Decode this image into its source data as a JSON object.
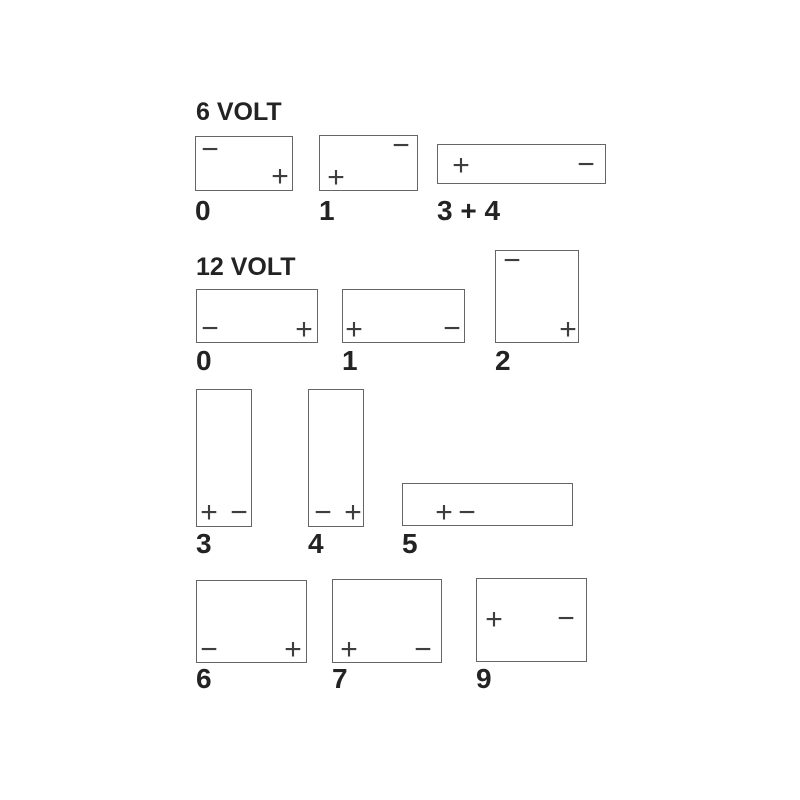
{
  "diagram": {
    "title": "Battery terminal layout diagram",
    "width": 800,
    "height": 800,
    "background": "#ffffff"
  },
  "colors": {
    "box_border": "#666666",
    "box_fill": "#ffffff",
    "heading_text": "#232323",
    "label_text": "#232323",
    "terminal_symbol": "#3e3e3e"
  },
  "sections": [
    {
      "title": "6 VOLT",
      "title_pos": {
        "x": 196,
        "y": 100
      },
      "batteries": [
        {
          "id": "6v-0",
          "label": "0",
          "label_y": 197,
          "box": {
            "x": 195,
            "y": 136,
            "w": 98,
            "h": 55
          },
          "terminals": [
            {
              "polarity": "negative",
              "glyph": "−",
              "x": 14,
              "y": 13
            },
            {
              "polarity": "positive",
              "glyph": "+",
              "x": 84,
              "y": 40
            }
          ]
        },
        {
          "id": "6v-1",
          "label": "1",
          "label_y": 197,
          "box": {
            "x": 319,
            "y": 135,
            "w": 99,
            "h": 56
          },
          "terminals": [
            {
              "polarity": "negative",
              "glyph": "−",
              "x": 81,
              "y": 10
            },
            {
              "polarity": "positive",
              "glyph": "+",
              "x": 16,
              "y": 42
            }
          ]
        },
        {
          "id": "6v-3-4",
          "label": "3 + 4",
          "label_y": 197,
          "box": {
            "x": 437,
            "y": 144,
            "w": 169,
            "h": 40
          },
          "terminals": [
            {
              "polarity": "positive",
              "glyph": "+",
              "x": 23,
              "y": 21
            },
            {
              "polarity": "negative",
              "glyph": "−",
              "x": 148,
              "y": 20
            }
          ]
        }
      ]
    },
    {
      "title": "12 VOLT",
      "title_pos": {
        "x": 196,
        "y": 255
      },
      "batteries": [
        {
          "id": "12v-0",
          "label": "0",
          "label_y": 347,
          "box": {
            "x": 196,
            "y": 289,
            "w": 122,
            "h": 54
          },
          "terminals": [
            {
              "polarity": "negative",
              "glyph": "−",
              "x": 13,
              "y": 39
            },
            {
              "polarity": "positive",
              "glyph": "+",
              "x": 107,
              "y": 40
            }
          ]
        },
        {
          "id": "12v-1",
          "label": "1",
          "label_y": 347,
          "box": {
            "x": 342,
            "y": 289,
            "w": 123,
            "h": 54
          },
          "terminals": [
            {
              "polarity": "positive",
              "glyph": "+",
              "x": 11,
              "y": 40
            },
            {
              "polarity": "negative",
              "glyph": "−",
              "x": 109,
              "y": 39
            }
          ]
        },
        {
          "id": "12v-2",
          "label": "2",
          "label_y": 347,
          "box": {
            "x": 495,
            "y": 250,
            "w": 84,
            "h": 93
          },
          "terminals": [
            {
              "polarity": "negative",
              "glyph": "−",
              "x": 16,
              "y": 10
            },
            {
              "polarity": "positive",
              "glyph": "+",
              "x": 72,
              "y": 79
            }
          ]
        }
      ]
    },
    {
      "batteries": [
        {
          "id": "12v-3",
          "label": "3",
          "label_y": 530,
          "box": {
            "x": 196,
            "y": 389,
            "w": 56,
            "h": 138
          },
          "terminals": [
            {
              "polarity": "positive",
              "glyph": "+",
              "x": 12,
              "y": 123
            },
            {
              "polarity": "negative",
              "glyph": "−",
              "x": 42,
              "y": 123
            }
          ]
        },
        {
          "id": "12v-4",
          "label": "4",
          "label_y": 530,
          "box": {
            "x": 308,
            "y": 389,
            "w": 56,
            "h": 138
          },
          "terminals": [
            {
              "polarity": "negative",
              "glyph": "−",
              "x": 14,
              "y": 123
            },
            {
              "polarity": "positive",
              "glyph": "+",
              "x": 44,
              "y": 123
            }
          ]
        },
        {
          "id": "12v-5",
          "label": "5",
          "label_y": 530,
          "box": {
            "x": 402,
            "y": 483,
            "w": 171,
            "h": 43
          },
          "terminals": [
            {
              "polarity": "positive",
              "glyph": "+",
              "x": 41,
              "y": 29
            },
            {
              "polarity": "negative",
              "glyph": "−",
              "x": 64,
              "y": 29
            }
          ]
        }
      ]
    },
    {
      "batteries": [
        {
          "id": "12v-6",
          "label": "6",
          "label_y": 665,
          "box": {
            "x": 196,
            "y": 580,
            "w": 111,
            "h": 83
          },
          "terminals": [
            {
              "polarity": "negative",
              "glyph": "−",
              "x": 12,
              "y": 69
            },
            {
              "polarity": "positive",
              "glyph": "+",
              "x": 96,
              "y": 69
            }
          ]
        },
        {
          "id": "12v-7",
          "label": "7",
          "label_y": 665,
          "box": {
            "x": 332,
            "y": 579,
            "w": 110,
            "h": 84
          },
          "terminals": [
            {
              "polarity": "positive",
              "glyph": "+",
              "x": 16,
              "y": 70
            },
            {
              "polarity": "negative",
              "glyph": "−",
              "x": 90,
              "y": 70
            }
          ]
        },
        {
          "id": "12v-9",
          "label": "9",
          "label_y": 665,
          "box": {
            "x": 476,
            "y": 578,
            "w": 111,
            "h": 84
          },
          "terminals": [
            {
              "polarity": "positive",
              "glyph": "+",
              "x": 17,
              "y": 41
            },
            {
              "polarity": "negative",
              "glyph": "−",
              "x": 89,
              "y": 40
            }
          ]
        }
      ]
    }
  ]
}
